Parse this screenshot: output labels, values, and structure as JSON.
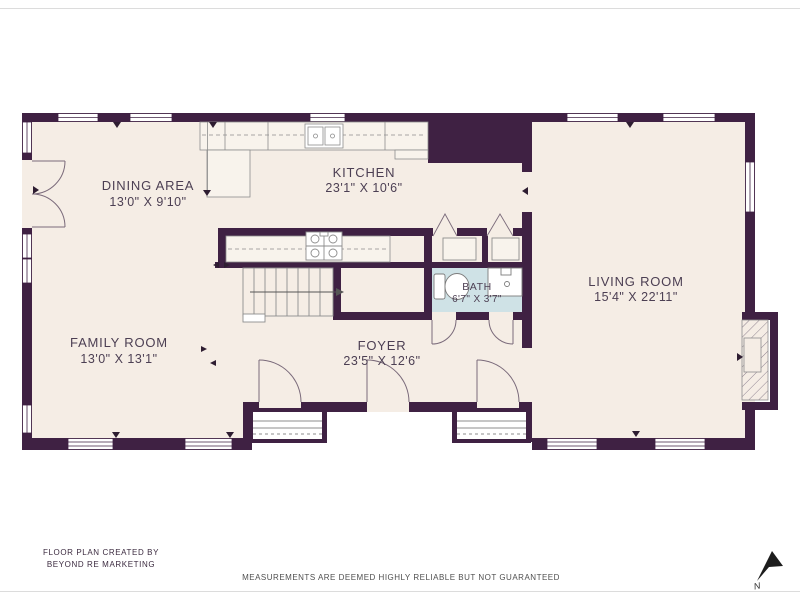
{
  "floor_plan": {
    "rooms": {
      "dining": {
        "name": "DINING AREA",
        "dims": "13'0\" X 9'10\""
      },
      "kitchen": {
        "name": "KITCHEN",
        "dims": "23'1\" X 10'6\""
      },
      "living": {
        "name": "LIVING ROOM",
        "dims": "15'4\" X 22'11\""
      },
      "family": {
        "name": "FAMILY ROOM",
        "dims": "13'0\" X 13'1\""
      },
      "foyer": {
        "name": "FOYER",
        "dims": "23'5\" X 12'6\""
      },
      "bath": {
        "name": "BATH",
        "dims": "6'7\" X 3'7\""
      }
    },
    "compass": {
      "label": "N"
    },
    "colors": {
      "wall": "#3f2143",
      "floor": "#f5ede5",
      "counter": "#f8f3ec",
      "bath_floor": "#cfe2e6",
      "label_text": "#4c3f53",
      "fixture_line": "#8d8d8d"
    }
  },
  "footer": {
    "credit_line1": "FLOOR PLAN CREATED BY",
    "credit_line2": "BEYOND RE MARKETING",
    "disclaimer": "MEASUREMENTS ARE DEEMED HIGHLY RELIABLE BUT NOT GUARANTEED"
  }
}
